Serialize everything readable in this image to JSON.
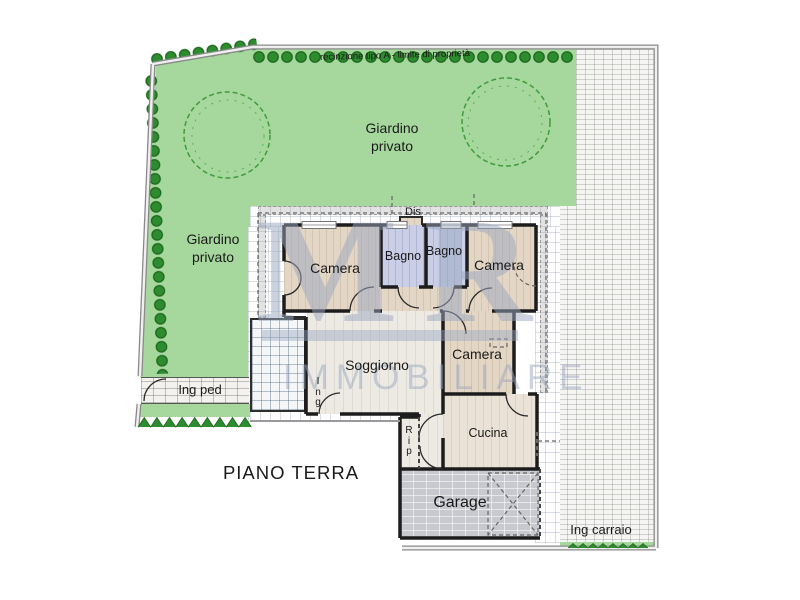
{
  "title": "PIANO TERRA",
  "labels": {
    "fence": "recinzione tipo A - limite di proprietà",
    "garden_top": "Giardino\nprivato",
    "garden_left": "Giardino\nprivato",
    "dis": "Dis",
    "camera_nw": "Camera",
    "bagno_w": "Bagno",
    "bagno_e": "Bagno",
    "camera_ne": "Camera",
    "camera_e": "Camera",
    "soggiorno": "Soggiorno",
    "ing": "I\nn\ng",
    "rip": "R\ni\np",
    "cucina": "Cucina",
    "garage": "Garage",
    "ing_ped": "Ing ped",
    "ing_carraio": "Ing carraio",
    "piano_terra": "PIANO TERRA"
  },
  "watermark": {
    "letters": "MR",
    "text": "IMMOBILIARE"
  },
  "colors": {
    "garden": "#a6d89d",
    "shrub": "#2d8c2d",
    "shrub_dark": "#1d671d",
    "wood_floor": "#e3d6c5",
    "bath_floor": "#cacee7",
    "light_floor": "#edeae4",
    "cucina_floor": "#eae2d6",
    "garage_fill": "#c7c9cf",
    "wall": "#1c1c1c",
    "fence_gray": "#8a8a8a",
    "watermark": "#9aa8c0"
  }
}
